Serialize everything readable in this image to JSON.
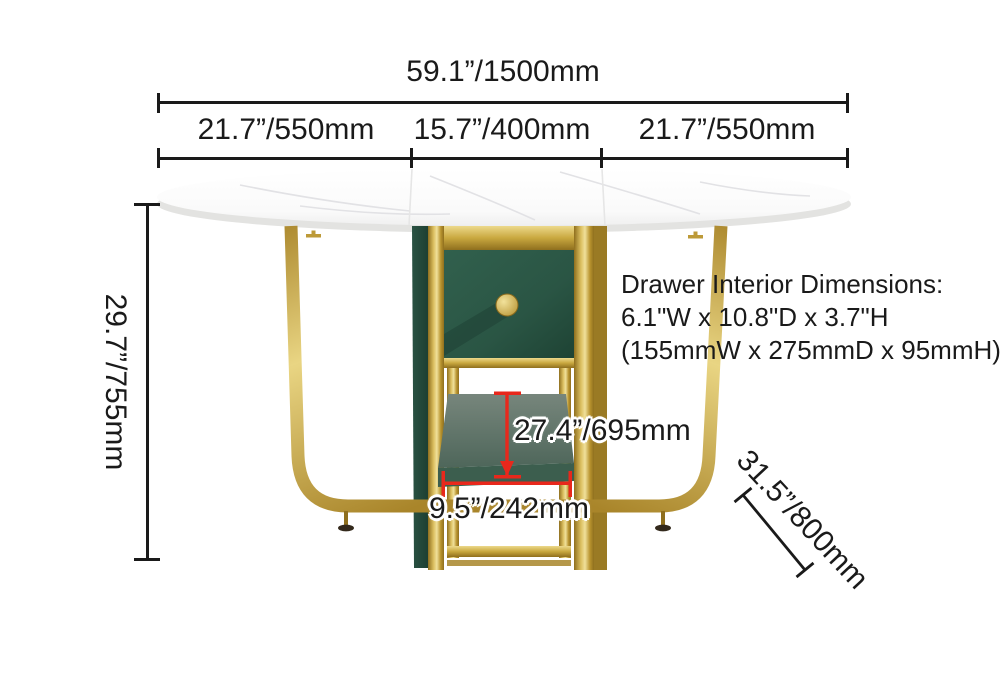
{
  "diagram_title": "Folding dining table dimension diagram",
  "dimensions": {
    "total_width": "59.1”/1500mm",
    "segment_left": "21.7”/550mm",
    "segment_middle": "15.7”/400mm",
    "segment_right": "21.7”/550mm",
    "height": "29.7”/755mm",
    "clearance_height": "27.4”/695mm",
    "inner_width": "9.5”/242mm",
    "depth": "31.5”/800mm"
  },
  "drawer_note": {
    "title": "Drawer Interior Dimensions:",
    "inches": "6.1\"W x 10.8\"D x 3.7\"H",
    "metric": "(155mmW x 275mmD x 95mmH)"
  },
  "colors": {
    "text": "#1a1a1a",
    "dimension_red": "#e8281c",
    "gold_main": "#c2a13c",
    "gold_light": "#ecd98b",
    "gold_dark": "#8f6f1e",
    "green_drawer": "#2a5544",
    "green_dark": "#1e4334",
    "green_side": "#24483a",
    "seat_top": "#6e8076",
    "seat_front": "#3c5e4e",
    "marble_white": "#fdfdfd",
    "marble_edge": "#e3e3e1"
  }
}
